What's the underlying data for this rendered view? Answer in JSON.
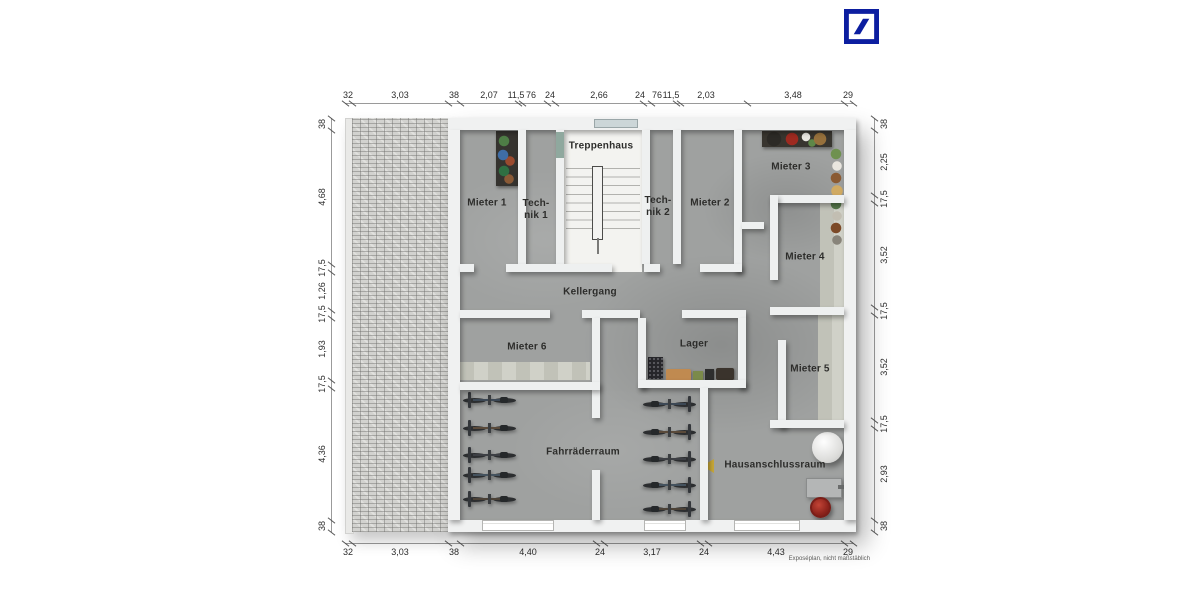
{
  "logo": {
    "brand": "deutsche-bank-logo",
    "color": "#0C1EA0"
  },
  "footer": {
    "disclaimer": "Exposéplan, nicht maßstäblich"
  },
  "rooms": {
    "treppenhaus": "Treppenhaus",
    "mieter1": "Mieter 1",
    "technik1_l1": "Tech-",
    "technik1_l2": "nik 1",
    "technik2_l1": "Tech-",
    "technik2_l2": "nik 2",
    "mieter2": "Mieter 2",
    "mieter3": "Mieter 3",
    "mieter4": "Mieter 4",
    "mieter5": "Mieter 5",
    "mieter6": "Mieter 6",
    "kellergang": "Kellergang",
    "lager": "Lager",
    "fahrraederraum": "Fahrräderraum",
    "hausanschlussraum": "Hausanschlussraum"
  },
  "dimensions": {
    "top": {
      "line": 103,
      "from": 345,
      "to": 853,
      "ticks": [
        345,
        352,
        448,
        460,
        518,
        522,
        547,
        555,
        643,
        651,
        676,
        680,
        747,
        844,
        853
      ],
      "labels": [
        {
          "t": "32",
          "p": 348
        },
        {
          "t": "3,03",
          "p": 400
        },
        {
          "t": "38",
          "p": 454
        },
        {
          "t": "2,07",
          "p": 489
        },
        {
          "t": "11,5",
          "p": 516
        },
        {
          "t": "76",
          "p": 531
        },
        {
          "t": "24",
          "p": 550
        },
        {
          "t": "2,66",
          "p": 599
        },
        {
          "t": "24",
          "p": 640
        },
        {
          "t": "76",
          "p": 657
        },
        {
          "t": "11,5",
          "p": 671
        },
        {
          "t": "2,03",
          "p": 706
        },
        {
          "t": "3,48",
          "p": 793
        },
        {
          "t": "29",
          "p": 848
        }
      ]
    },
    "bottom": {
      "line": 543,
      "from": 345,
      "to": 853,
      "ticks": [
        345,
        352,
        448,
        460,
        596,
        604,
        700,
        708,
        844,
        853
      ],
      "labels": [
        {
          "t": "32",
          "p": 348
        },
        {
          "t": "3,03",
          "p": 400
        },
        {
          "t": "38",
          "p": 454
        },
        {
          "t": "4,40",
          "p": 528
        },
        {
          "t": "24",
          "p": 600
        },
        {
          "t": "3,17",
          "p": 652
        },
        {
          "t": "24",
          "p": 704
        },
        {
          "t": "4,43",
          "p": 776
        },
        {
          "t": "29",
          "p": 848
        }
      ]
    },
    "left": {
      "line": 331,
      "from": 118,
      "to": 532,
      "ticks": [
        118,
        130,
        264,
        272,
        310,
        318,
        380,
        388,
        520,
        532
      ],
      "labels": [
        {
          "t": "38",
          "p": 124
        },
        {
          "t": "4,68",
          "p": 197
        },
        {
          "t": "17,5",
          "p": 268
        },
        {
          "t": "1,26",
          "p": 291
        },
        {
          "t": "17,5",
          "p": 314
        },
        {
          "t": "1,93",
          "p": 349
        },
        {
          "t": "17,5",
          "p": 384
        },
        {
          "t": "4,36",
          "p": 454
        },
        {
          "t": "38",
          "p": 526
        }
      ]
    },
    "right": {
      "line": 874,
      "from": 118,
      "to": 532,
      "ticks": [
        118,
        130,
        195,
        203,
        307,
        315,
        420,
        428,
        520,
        532
      ],
      "labels": [
        {
          "t": "38",
          "p": 124
        },
        {
          "t": "2,25",
          "p": 162
        },
        {
          "t": "17,5",
          "p": 199
        },
        {
          "t": "3,52",
          "p": 255
        },
        {
          "t": "17,5",
          "p": 311
        },
        {
          "t": "3,52",
          "p": 367
        },
        {
          "t": "17,5",
          "p": 424
        },
        {
          "t": "2,93",
          "p": 474
        },
        {
          "t": "38",
          "p": 526
        }
      ]
    }
  },
  "bikes": {
    "rows": [
      {
        "x": 462,
        "ys": [
          392,
          420,
          447,
          467,
          491
        ],
        "flip": false
      },
      {
        "x": 641,
        "ys": [
          396,
          424,
          451,
          477,
          501
        ],
        "flip": true
      }
    ],
    "frame_colors": [
      "#3c4855",
      "#5a4a3a",
      "#3d3f44",
      "#44525e",
      "#4c4237"
    ]
  },
  "colors": {
    "wall": "#eef0f0",
    "floor": "#9fa1a0",
    "stairs_floor": "#f3f3f0",
    "light_strip": "#cbccc2",
    "paving": "#d2d2cf",
    "db_blue": "#0C1EA0"
  }
}
